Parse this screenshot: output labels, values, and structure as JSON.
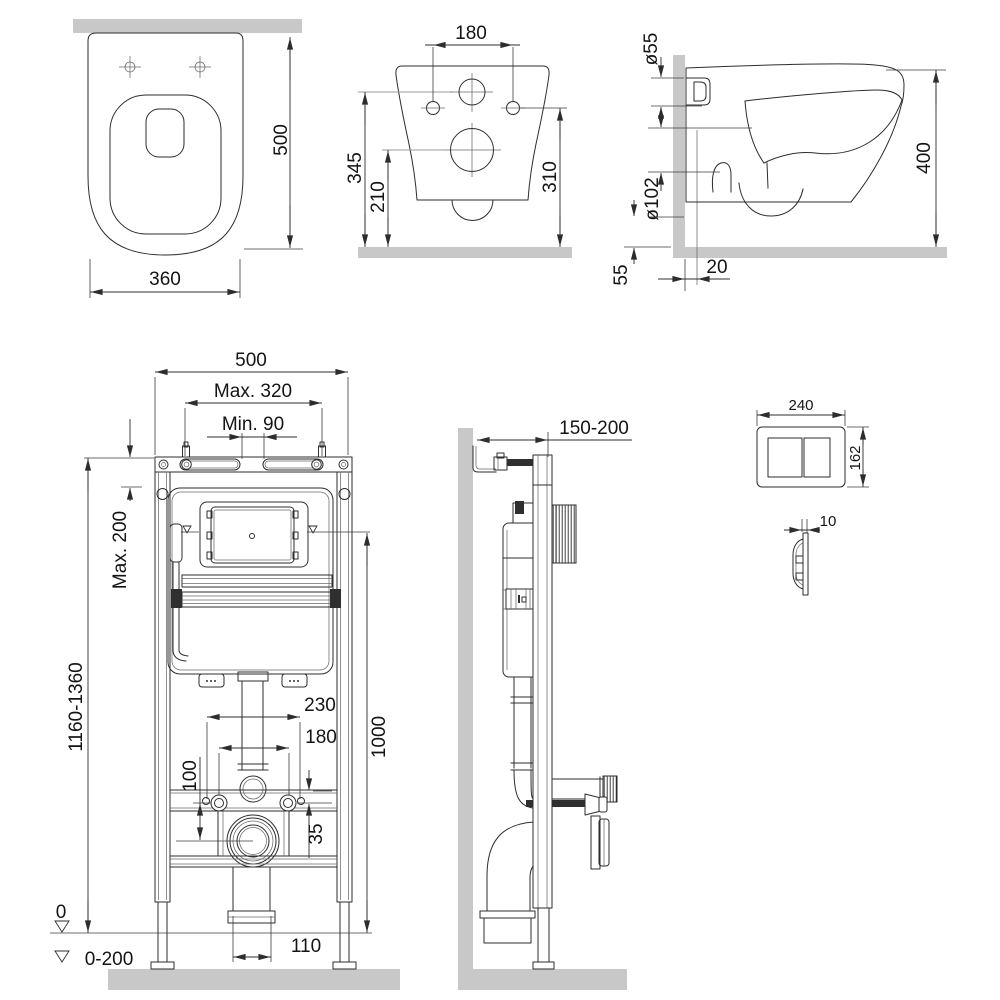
{
  "colors": {
    "line": "#2d2d2d",
    "surface_gray": "#c8c8c8",
    "background": "#ffffff"
  },
  "views": {
    "toilet_plan": {
      "depth": "500",
      "width": "360"
    },
    "toilet_rear": {
      "bolt_spacing": "180",
      "inlet_height": "345",
      "outlet_height": "210",
      "side_hole_height": "310"
    },
    "toilet_side": {
      "inlet_diameter": "ø55",
      "outlet_diameter": "ø102",
      "total_height": "400",
      "under_clearance": "55",
      "wall_gap": "20"
    },
    "frame_front": {
      "frame_width": "500",
      "max_spacing": "Max. 320",
      "min_spacing": "Min. 90",
      "max_top_offset": "Max. 200",
      "frame_height_range": "1160-1360",
      "supply_offset": "100",
      "conn_spacing_outer": "230",
      "conn_spacing_inner": "180",
      "plate_axis_height": "1000",
      "rail_offset": "35",
      "zero_level": "0",
      "drain_width": "110",
      "floor_level_range": "0-200"
    },
    "frame_side": {
      "frame_depth_range": "150-200"
    },
    "flush_plate": {
      "plate_width": "240",
      "plate_height": "162",
      "plate_thickness": "10"
    }
  }
}
